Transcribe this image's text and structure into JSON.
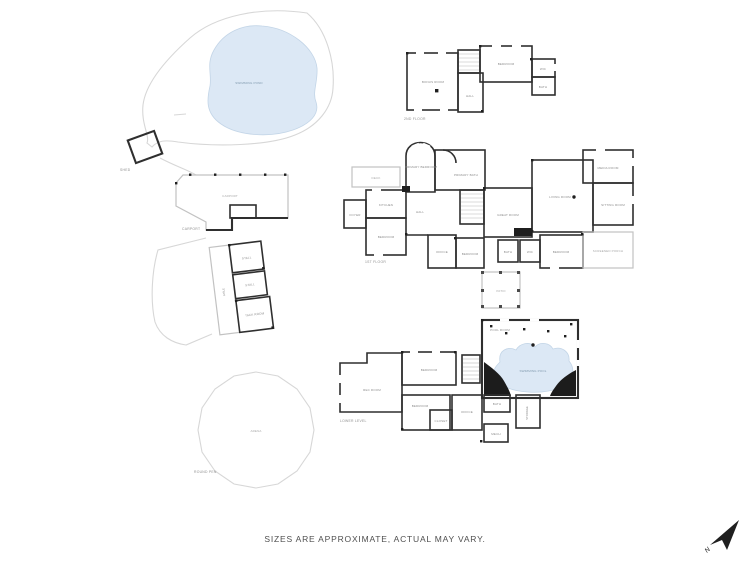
{
  "canvas": {
    "background": "#ffffff"
  },
  "footer": {
    "disclaimer": "SIZES ARE APPROXIMATE, ACTUAL MAY VARY."
  },
  "compass": {
    "label": "N"
  },
  "colors": {
    "water": "#dce8f5",
    "wall_dark": "#2f2f2f",
    "wall_light": "#c2c2c2",
    "site_outline": "#d7d7d7",
    "rock_black": "#1c1c1c"
  },
  "site": {
    "pond": {
      "label": "SWIMMING POND"
    },
    "shed": {
      "caption": "SHED"
    },
    "carport": {
      "label": "CARPORT",
      "caption": "CARPORT"
    },
    "barn": {
      "aisle": "AISLE",
      "stall1": "STALL",
      "stall2": "STALL",
      "tack": "TACK ROOM"
    },
    "round_pen": {
      "label": "ARENA",
      "caption": "ROUND PEN"
    }
  },
  "second_floor": {
    "caption": "2ND FLOOR",
    "rooms": {
      "bonus": "BONUS ROOM",
      "bedroom": "BEDROOM",
      "wic": "WIC",
      "bath": "BATH",
      "hall": "HALL"
    }
  },
  "first_floor": {
    "caption": "1ST FLOOR",
    "rooms": {
      "primary_bedroom": "PRIMARY BEDROOM",
      "primary_bath": "PRIMARY BATH",
      "great_room": "GREAT ROOM",
      "living_room": "LIVING ROOM",
      "media_room": "MEDIA ROOM",
      "sitting_room": "SITTING ROOM",
      "kitchen": "KITCHEN",
      "foyer": "FOYER",
      "deck": "DECK",
      "hall": "HALL",
      "bedroom_left": "BEDROOM",
      "office": "OFFICE",
      "bedroom_mid": "BEDROOM",
      "bath": "BATH",
      "wic": "WIC",
      "bedroom_right": "BEDROOM",
      "screened_porch": "SCREENED PORCH",
      "patio": "PATIO"
    }
  },
  "lower_level": {
    "caption": "LOWER LEVEL",
    "pool": {
      "room_label": "POOL ROOM",
      "water_label": "SWIMMING POOL"
    },
    "rooms": {
      "rec": "REC ROOM",
      "bedroom_top": "BEDROOM",
      "bedroom_bottom": "BEDROOM",
      "closet": "CLOSET",
      "office": "OFFICE",
      "bath": "BATH",
      "mech": "MECH",
      "storage": "STORAGE"
    }
  }
}
